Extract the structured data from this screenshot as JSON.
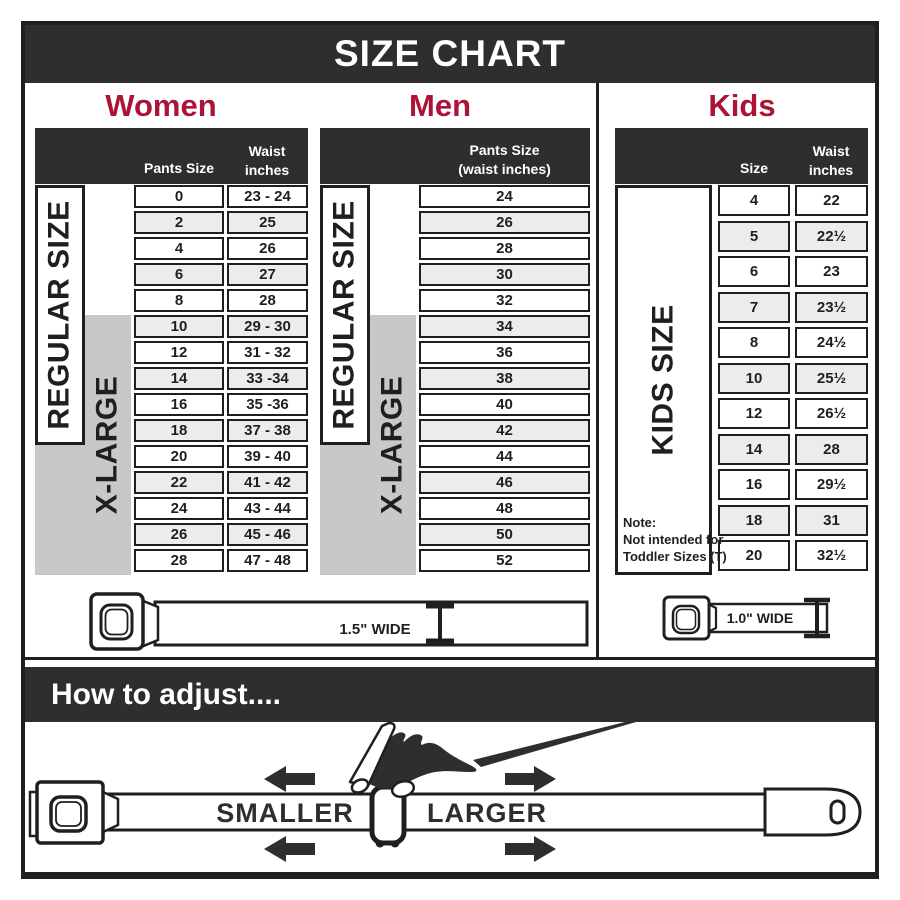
{
  "title": "SIZE CHART",
  "headings": {
    "women": "Women",
    "men": "Men",
    "kids": "Kids"
  },
  "adjust": {
    "heading": "How to adjust....",
    "smaller": "SMALLER",
    "larger": "LARGER"
  },
  "belts": {
    "adult": {
      "width_label": "1.5\" WIDE"
    },
    "kids": {
      "width_label": "1.0\" WIDE"
    }
  },
  "colors": {
    "band_dark": "#2e2e2e",
    "accent_red": "#ab1437",
    "line_dark": "#1f1f1f",
    "row_alt": "#ececec",
    "gray_block": "#c8c8c8"
  },
  "chart_data": [
    {
      "type": "table",
      "title": "Women",
      "columns": [
        "Pants Size",
        "Waist inches"
      ],
      "rows": [
        [
          "0",
          "23 - 24"
        ],
        [
          "2",
          "25"
        ],
        [
          "4",
          "26"
        ],
        [
          "6",
          "27"
        ],
        [
          "8",
          "28"
        ],
        [
          "10",
          "29 - 30"
        ],
        [
          "12",
          "31 - 32"
        ],
        [
          "14",
          "33 -34"
        ],
        [
          "16",
          "35 -36"
        ],
        [
          "18",
          "37 - 38"
        ],
        [
          "20",
          "39 - 40"
        ],
        [
          "22",
          "41 - 42"
        ],
        [
          "24",
          "43 - 44"
        ],
        [
          "26",
          "45 - 46"
        ],
        [
          "28",
          "47 - 48"
        ]
      ],
      "size_groups": [
        {
          "label": "REGULAR SIZE",
          "pants_sizes": "0 - 18"
        },
        {
          "label": "X-LARGE",
          "pants_sizes": "10 - 28"
        }
      ]
    },
    {
      "type": "table",
      "title": "Men",
      "columns": [
        "Pants Size (waist inches)"
      ],
      "header_lines": [
        "Pants Size",
        "(waist inches)"
      ],
      "rows": [
        [
          "24"
        ],
        [
          "26"
        ],
        [
          "28"
        ],
        [
          "30"
        ],
        [
          "32"
        ],
        [
          "34"
        ],
        [
          "36"
        ],
        [
          "38"
        ],
        [
          "40"
        ],
        [
          "42"
        ],
        [
          "44"
        ],
        [
          "46"
        ],
        [
          "48"
        ],
        [
          "50"
        ],
        [
          "52"
        ]
      ],
      "size_groups": [
        {
          "label": "REGULAR SIZE",
          "pants_sizes": "24 - 42"
        },
        {
          "label": "X-LARGE",
          "pants_sizes": "34 - 52"
        }
      ]
    },
    {
      "type": "table",
      "title": "Kids",
      "columns": [
        "Size",
        "Waist inches"
      ],
      "rows": [
        [
          "4",
          "22"
        ],
        [
          "5",
          "22½"
        ],
        [
          "6",
          "23"
        ],
        [
          "7",
          "23½"
        ],
        [
          "8",
          "24½"
        ],
        [
          "10",
          "25½"
        ],
        [
          "12",
          "26½"
        ],
        [
          "14",
          "28"
        ],
        [
          "16",
          "29½"
        ],
        [
          "18",
          "31"
        ],
        [
          "20",
          "32½"
        ]
      ],
      "size_groups": [
        {
          "label": "KIDS SIZE",
          "sizes": "4 - 20"
        }
      ],
      "note_lines": [
        "Note:",
        "Not intended for",
        "Toddler Sizes (T)"
      ]
    }
  ]
}
